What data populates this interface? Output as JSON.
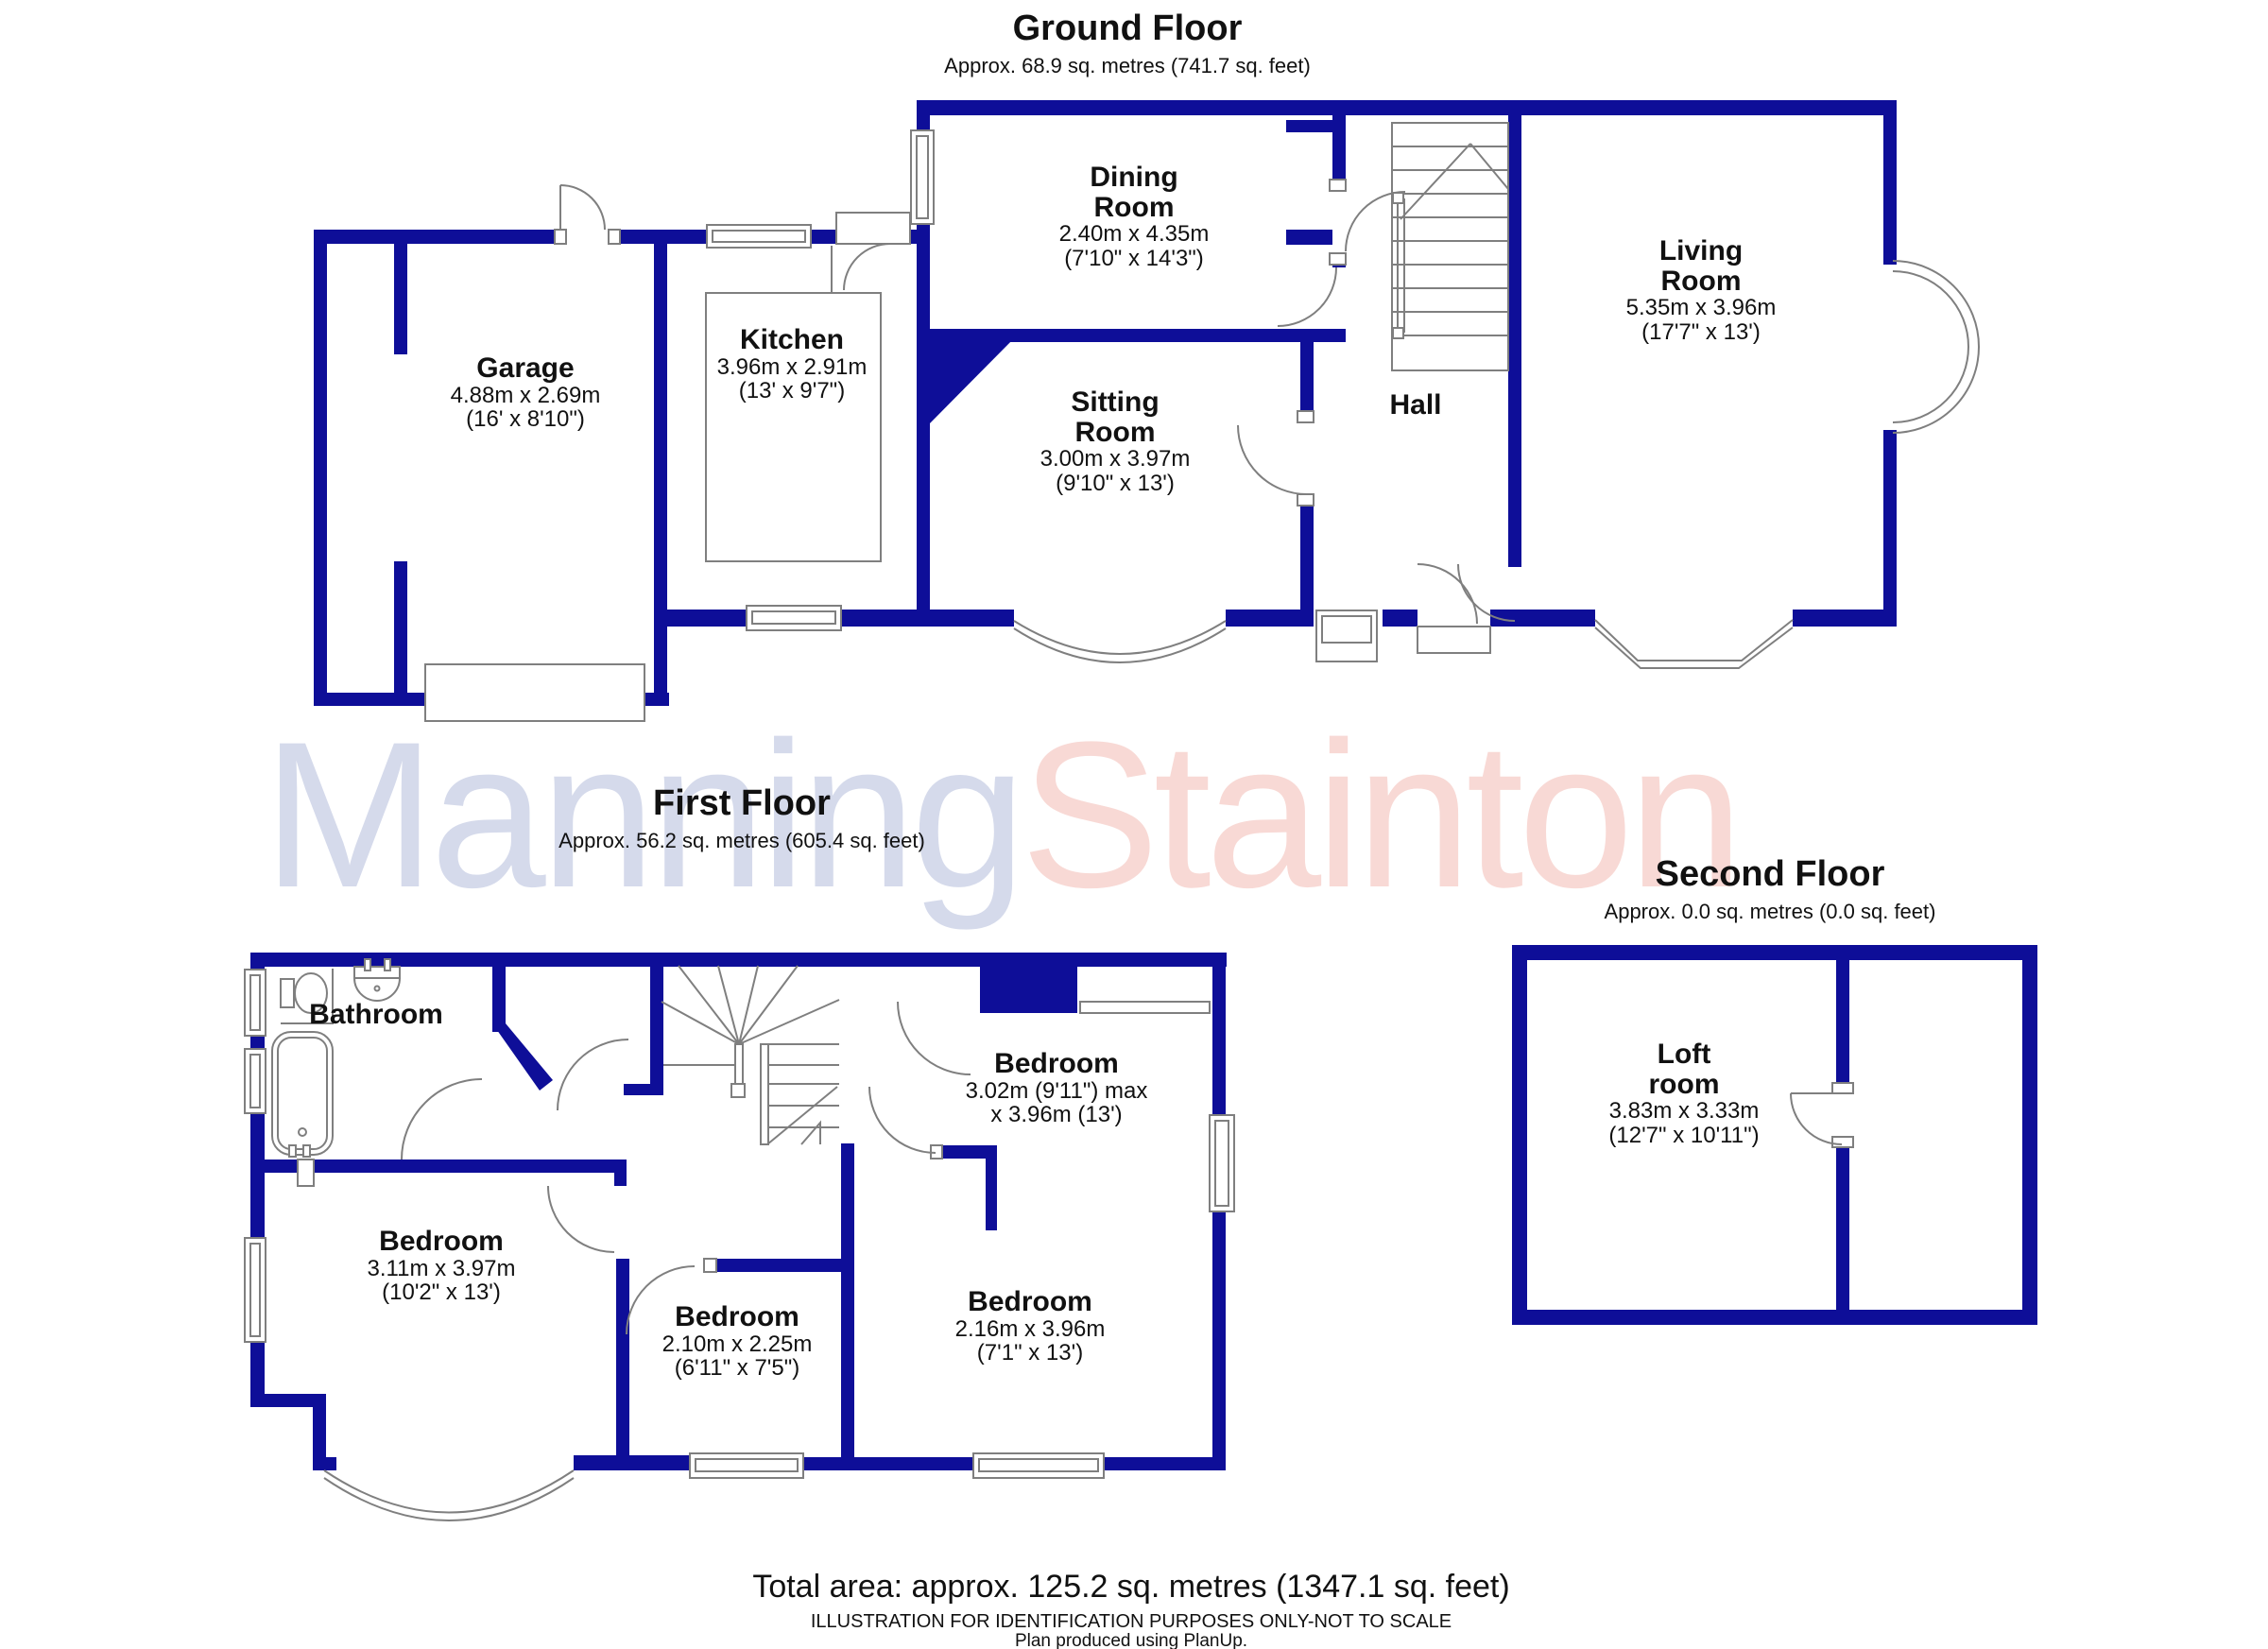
{
  "floors": {
    "ground": {
      "title": "Ground Floor",
      "subtitle": "Approx. 68.9 sq. metres (741.7 sq. feet)"
    },
    "first": {
      "title": "First Floor",
      "subtitle": "Approx. 56.2 sq. metres (605.4 sq. feet)"
    },
    "second": {
      "title": "Second Floor",
      "subtitle": "Approx. 0.0 sq. metres (0.0 sq. feet)"
    }
  },
  "rooms": {
    "garage": {
      "name1": "Garage",
      "metric": "4.88m x 2.69m",
      "imperial": "(16' x 8'10\")"
    },
    "kitchen": {
      "name1": "Kitchen",
      "metric": "3.96m x 2.91m",
      "imperial": "(13' x 9'7\")"
    },
    "dining": {
      "name1": "Dining",
      "name2": "Room",
      "metric": "2.40m x 4.35m",
      "imperial": "(7'10\" x 14'3\")"
    },
    "sitting": {
      "name1": "Sitting",
      "name2": "Room",
      "metric": "3.00m x 3.97m",
      "imperial": "(9'10\" x 13')"
    },
    "hall": {
      "name1": "Hall"
    },
    "living": {
      "name1": "Living",
      "name2": "Room",
      "metric": "5.35m x 3.96m",
      "imperial": "(17'7\" x 13')"
    },
    "bathroom": {
      "name1": "Bathroom"
    },
    "bedroom1": {
      "name1": "Bedroom",
      "metric": "3.02m (9'11\") max",
      "imperial": "x 3.96m (13')"
    },
    "bedroom2": {
      "name1": "Bedroom",
      "metric": "3.11m x 3.97m",
      "imperial": "(10'2\" x 13')"
    },
    "bedroom3": {
      "name1": "Bedroom",
      "metric": "2.10m x 2.25m",
      "imperial": "(6'11\" x 7'5\")"
    },
    "bedroom4": {
      "name1": "Bedroom",
      "metric": "2.16m x 3.96m",
      "imperial": "(7'1\" x 13')"
    },
    "loft": {
      "name1": "Loft",
      "name2": "room",
      "metric": "3.83m x 3.33m",
      "imperial": "(12'7\" x 10'11\")"
    }
  },
  "watermark": {
    "part1": "Manning",
    "part2": "Stainton"
  },
  "footer": {
    "total_area": "Total area: approx. 125.2 sq. metres (1347.1 sq. feet)",
    "disclaimer": "ILLUSTRATION FOR IDENTIFICATION PURPOSES ONLY-NOT TO SCALE",
    "produced_by": "Plan produced using PlanUp."
  },
  "colors": {
    "wall": "#0E0E98",
    "line": "#7f7f7f",
    "watermark_blue": "#d5daeb",
    "watermark_red": "#f8d9d5",
    "text": "#111111"
  }
}
